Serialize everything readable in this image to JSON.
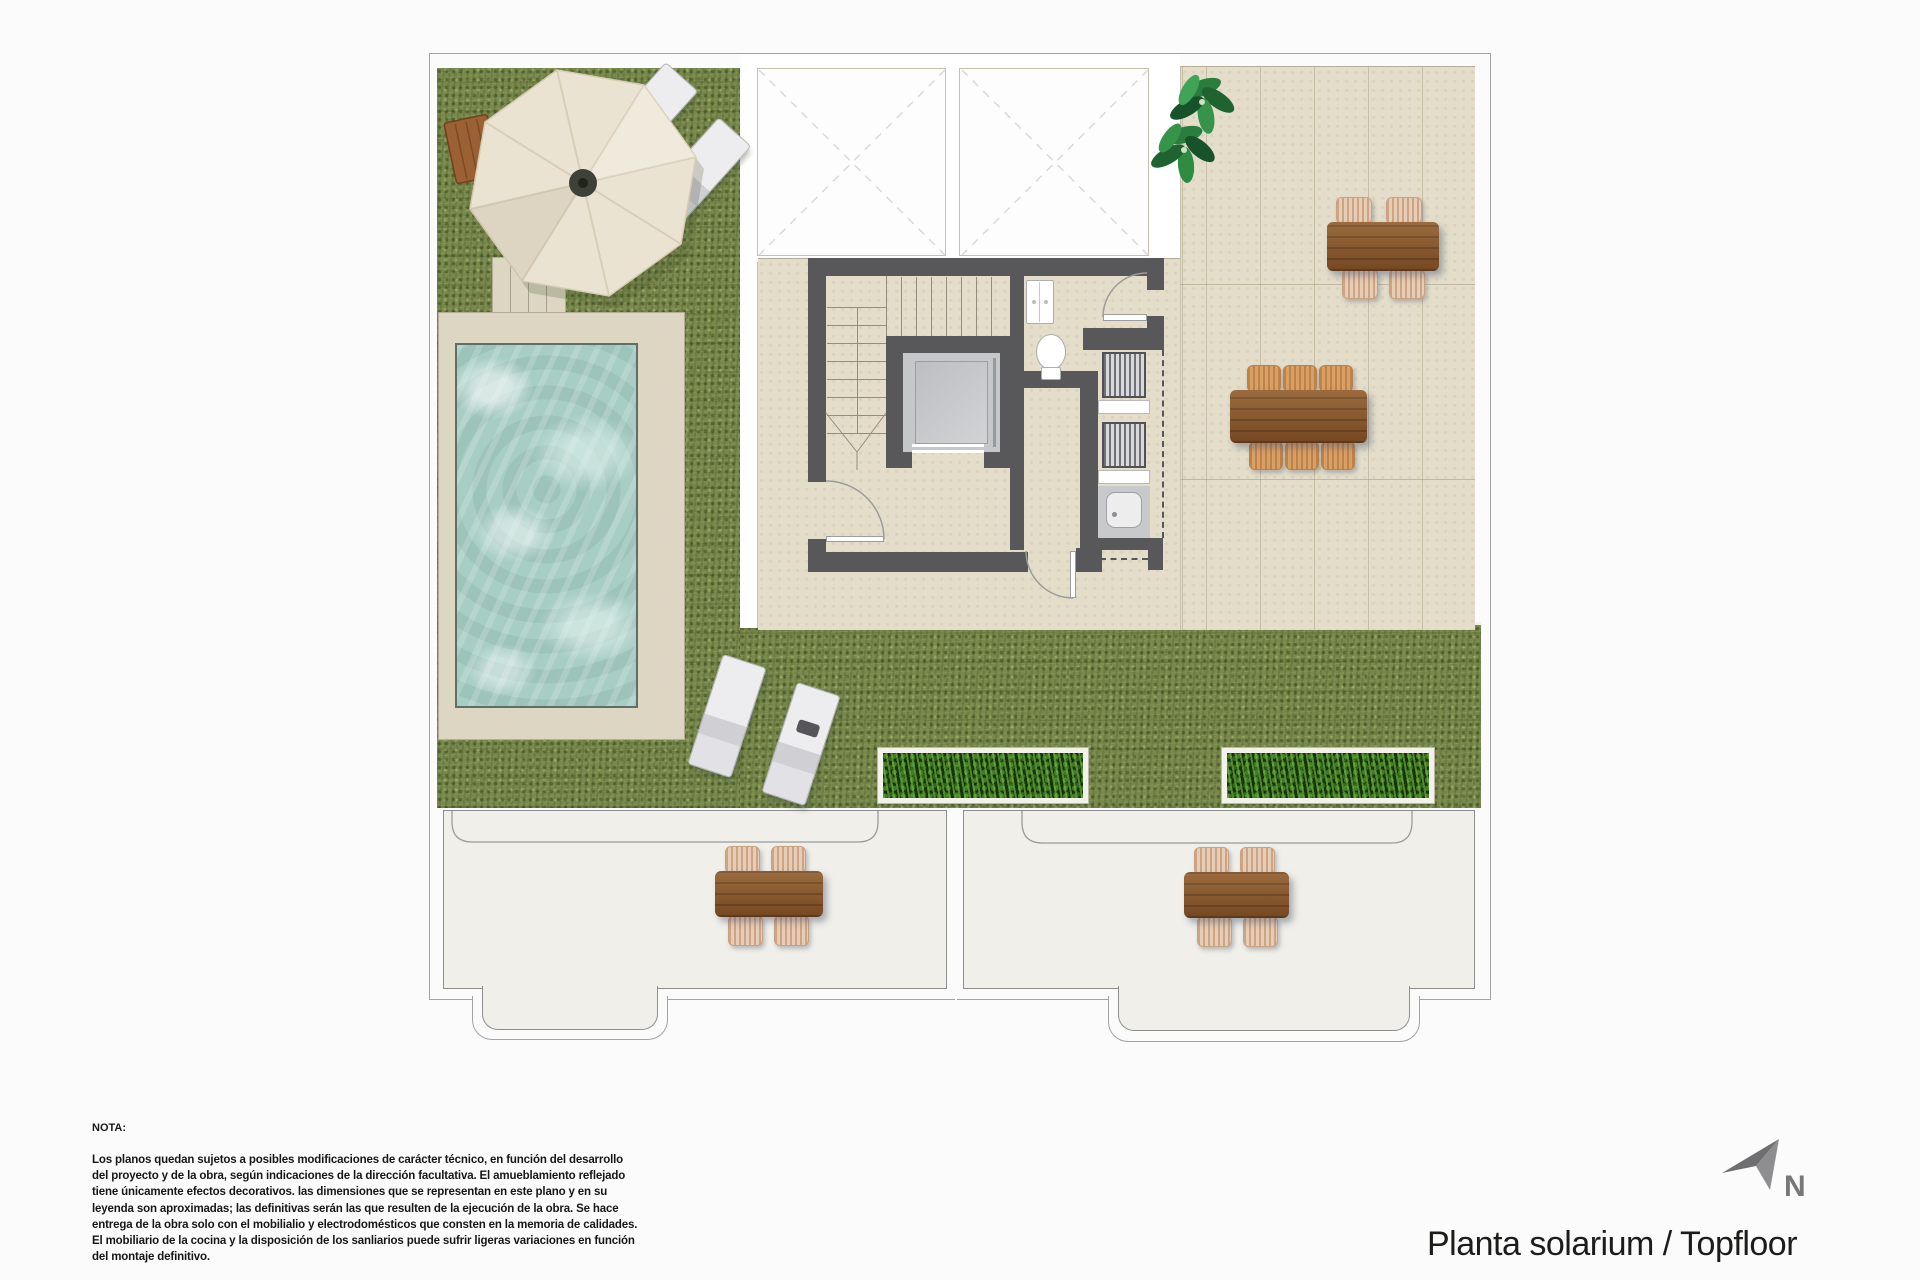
{
  "title": {
    "text": "Planta solarium / Topfloor"
  },
  "compass": {
    "label": "N"
  },
  "notes": {
    "heading": "NOTA:",
    "lines": [
      "Los planos quedan sujetos a posibles modificaciones de carácter técnico, en función del desarrollo",
      "del proyecto y de la obra, según indicaciones de la dirección facultativa. El amueblamiento reflejado",
      "tiene únicamente efectos decorativos. las dimensiones que se representan en este plano y en su",
      "leyenda son aproximadas; las definitivas serán las que resulten de la ejecución de la obra. Se hace",
      "entrega de la obra solo con el mobilialio y electrodomésticos que consten en la memoria de calidades.",
      "El mobiliario de la cocina y la disposición de los sanliarios puede sufrir ligeras variaciones en función",
      "del montaje definitivo."
    ]
  },
  "colors": {
    "page": "#fbfbfb",
    "site_line": "#a3a3a3",
    "grass": "#79894b",
    "terrace": "#e3ddca",
    "terrace_line": "#b5ae9a",
    "deck": "#dcd6c3",
    "pool": "#a7cdc5",
    "pool_edge": "#5f6e66",
    "wall": "#58585b",
    "floor_light": "#f0efe9",
    "wood": "#865328",
    "wicker": "#e8cdb6",
    "chair_orange": "#d9a066",
    "lounger": "#ededef",
    "umbrella": "#ebe3d1",
    "plant": "#2a7d3c",
    "planter": "#2c451c",
    "elevator": "#c6c7c9",
    "fixture": "#ffffff",
    "north": "#77777a",
    "text": "#1c1c1a"
  }
}
